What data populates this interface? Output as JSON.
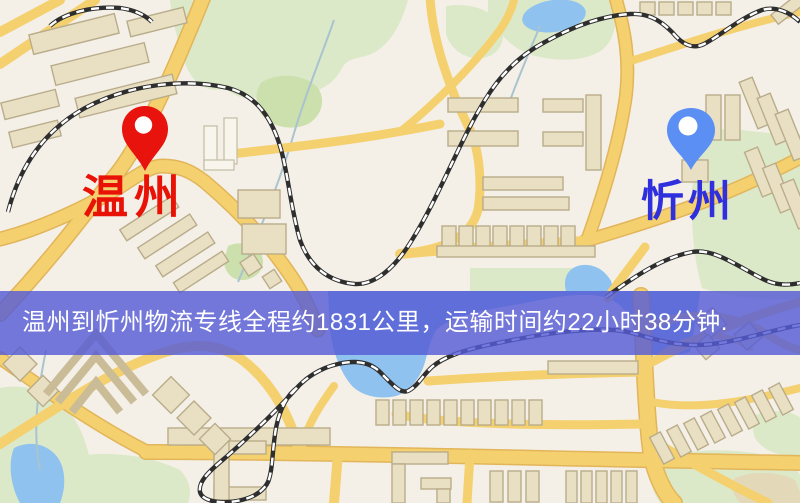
{
  "banner": {
    "text": "温州到忻州物流专线全程约1831公里，运输时间约22小时38分钟.",
    "background": "rgba(86,91,214,0.82)",
    "text_color": "#ffffff"
  },
  "markers": {
    "origin": {
      "label": "温州",
      "label_color": "#e91207",
      "pin_color": "#e8130c",
      "pin_icon": "red-map-pin"
    },
    "destination": {
      "label": "忻州",
      "label_color": "#2f2fdd",
      "pin_color": "#5b8ff3",
      "pin_icon": "blue-map-pin"
    }
  },
  "map_palette": {
    "background": "#f4f0e8",
    "road_fill": "#f4d06e",
    "road_casing": "#e2b55a",
    "building_fill": "#e9e0c4",
    "building_stroke": "#b9ac8a",
    "building_light": "#f8f6ec",
    "park": "#dce9c8",
    "park_dark": "#cbe0ad",
    "water": "#8fc2ee",
    "railway_dark": "#2e2e2e",
    "railway_light": "#ffffff",
    "stream": "#a9c3cf"
  }
}
